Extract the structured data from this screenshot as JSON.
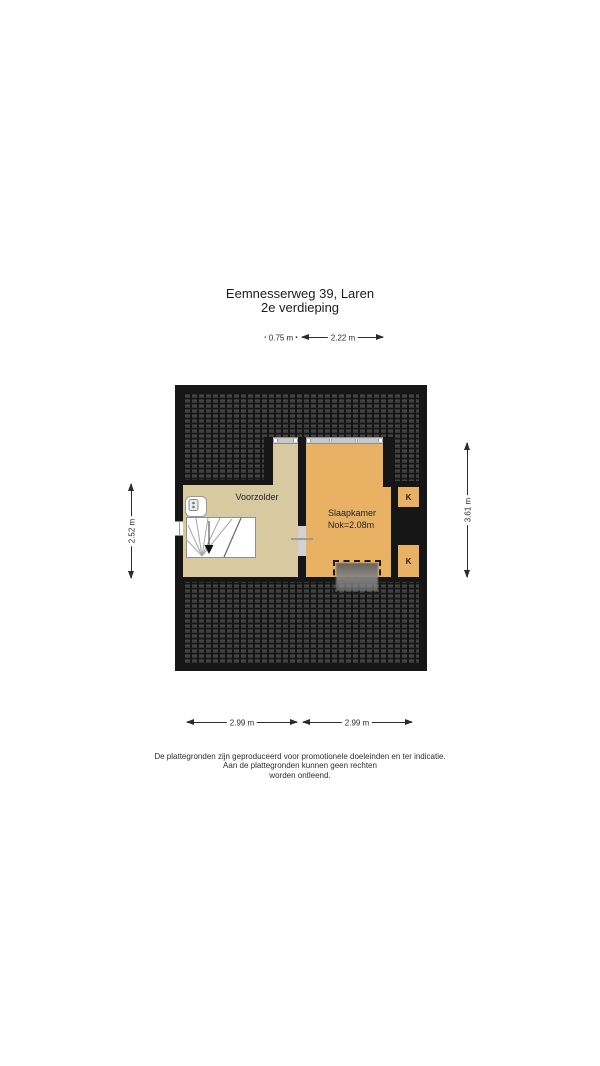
{
  "title": {
    "address": "Eemnesserweg 39, Laren",
    "floor": "2e verdieping"
  },
  "rooms": {
    "voorzolder": {
      "label": "Voorzolder"
    },
    "slaapkamer": {
      "label": "Slaapkamer",
      "ridge": "Nok=2.08m"
    },
    "closet_top": {
      "label": "K"
    },
    "closet_bottom": {
      "label": "K"
    }
  },
  "dimensions": {
    "top_small": "0.75 m",
    "top_wide": "2.22 m",
    "left": "2.52 m",
    "right": "3.61 m",
    "bottom_left": "2.99 m",
    "bottom_right": "2.99 m"
  },
  "disclaimer": [
    "De plattegronden zijn geproduceerd voor promotionele doeleinden en ter indicatie.",
    "Aan de plattegronden kunnen geen rechten",
    "worden ontleend."
  ],
  "colors": {
    "wall": "#161616",
    "roof_tile": "#3d3d3d",
    "roof_grout": "#151515",
    "voorzolder_fill": "#d8c9a1",
    "slaapkamer_fill": "#e9b164",
    "window_strip": "#c8c8c8",
    "dimension_text": "#2b2b2b"
  }
}
